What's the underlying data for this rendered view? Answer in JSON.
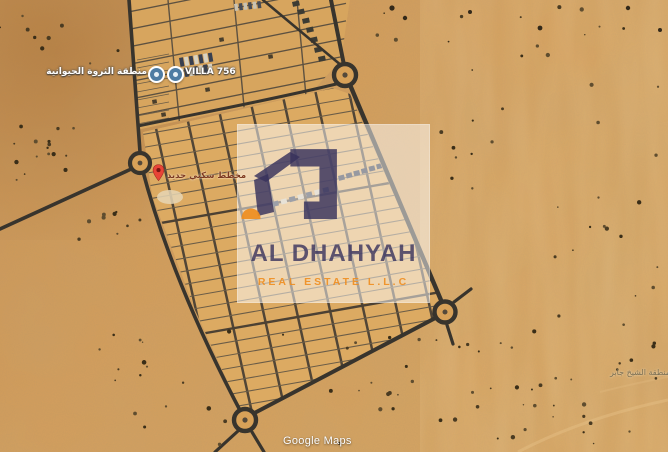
{
  "map": {
    "poi_markers": [
      {
        "label": "منطقة الثروة الحيوانية"
      },
      {
        "label": "VILLA 756"
      }
    ],
    "pin_marker": {
      "label": "مخطط سكني جديد"
    },
    "district_label": "منطقة الشيخ جابر",
    "attribution": "Google Maps"
  },
  "watermark": {
    "title": "AL DHAHYAH",
    "subtitle": "REAL ESTATE L.L.C",
    "navy": "#37315c",
    "orange": "#ee8d1f"
  },
  "theme": {
    "desert": "#d49a55",
    "road": "#38342d",
    "plot": "#dcaa62"
  }
}
